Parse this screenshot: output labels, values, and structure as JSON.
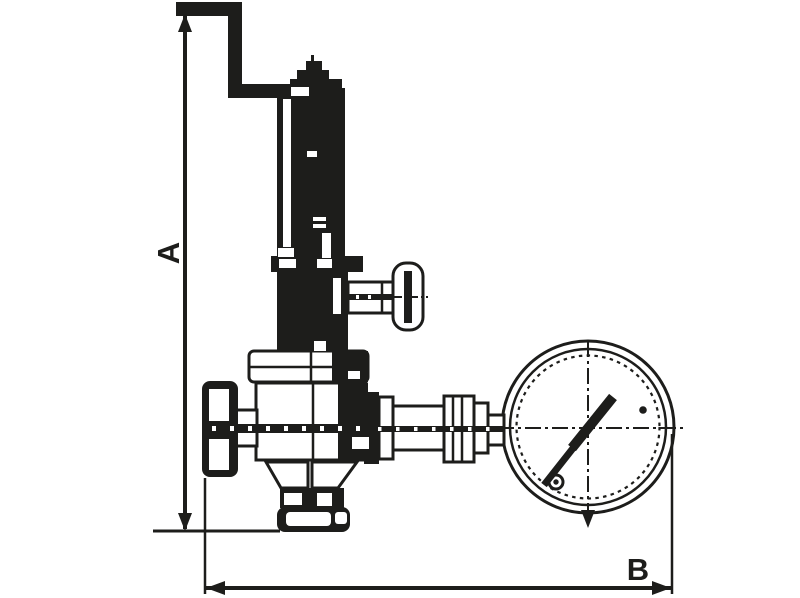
{
  "drawing": {
    "description": "technical outline drawing of a valve assembly with elbow pipe, side tap knob, inlet flange, union fittings and a round pressure gauge",
    "dimension_labels": {
      "vertical": "A",
      "horizontal": "B"
    },
    "colors": {
      "ink": "#1d1d1b",
      "background": "#ffffff"
    }
  }
}
